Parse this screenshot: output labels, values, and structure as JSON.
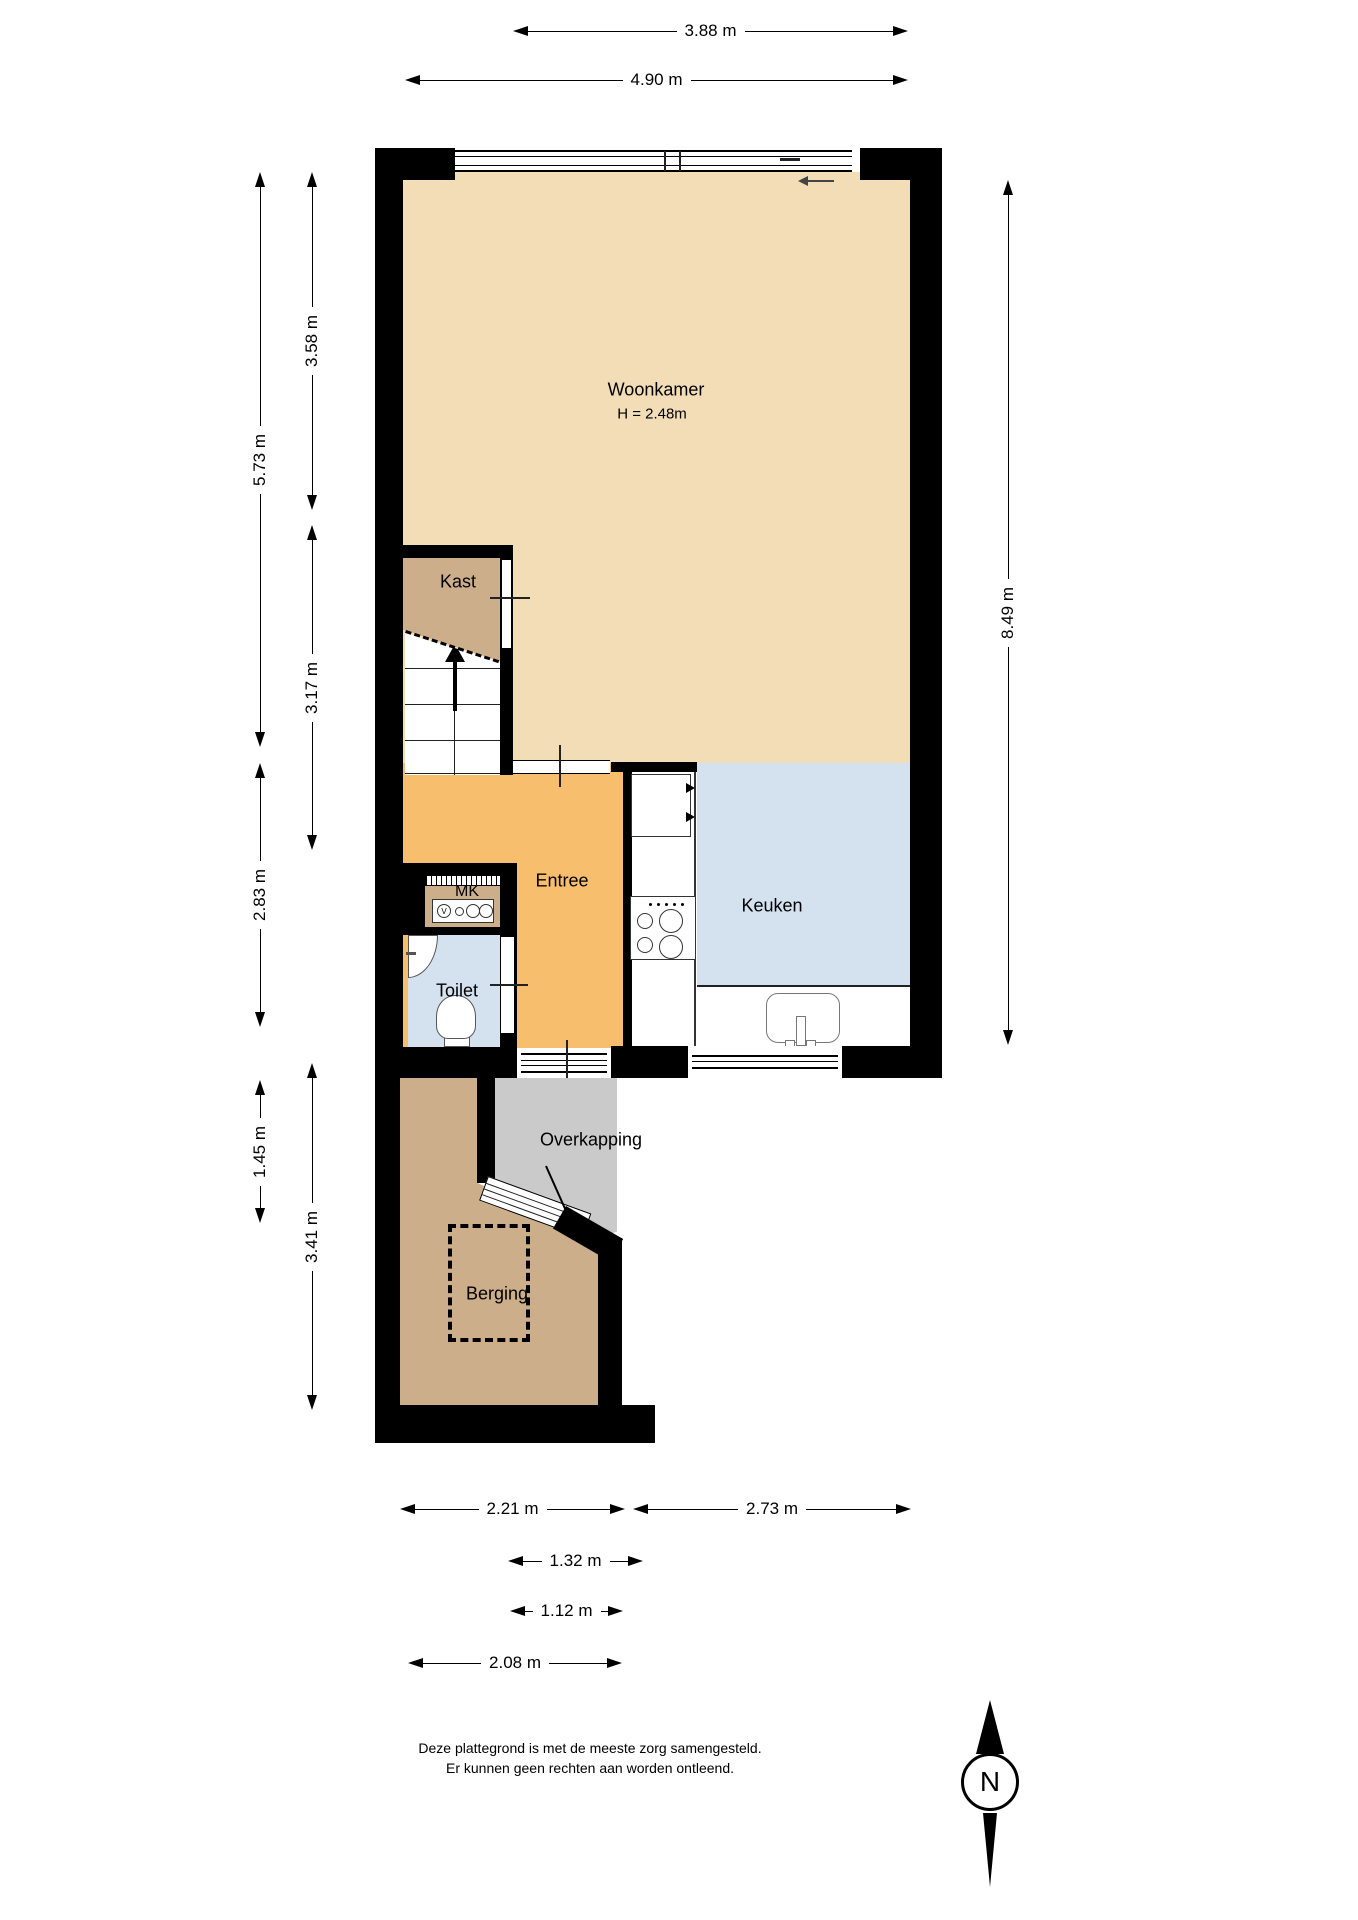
{
  "title": "floor-plan",
  "rooms": {
    "woonkamer": {
      "label": "Woonkamer",
      "height_note": "H = 2.48m"
    },
    "kast": {
      "label": "Kast"
    },
    "entree": {
      "label": "Entree"
    },
    "mk": {
      "label": "MK",
      "meter_letter": "V"
    },
    "toilet": {
      "label": "Toilet"
    },
    "keuken": {
      "label": "Keuken"
    },
    "overkapping": {
      "label": "Overkapping"
    },
    "berging": {
      "label": "Berging"
    }
  },
  "dimensions": {
    "top": [
      {
        "label": "3.88 m"
      },
      {
        "label": "4.90 m"
      }
    ],
    "right": [
      {
        "label": "8.49 m"
      }
    ],
    "left_outer": [
      {
        "label": "5.73 m"
      },
      {
        "label": "2.83 m"
      },
      {
        "label": "1.45 m"
      }
    ],
    "left_inner": [
      {
        "label": "3.58 m"
      },
      {
        "label": "3.17 m"
      },
      {
        "label": "3.41 m"
      }
    ],
    "bottom": [
      {
        "label": "2.21 m"
      },
      {
        "label": "2.73 m"
      },
      {
        "label": "1.32 m"
      },
      {
        "label": "1.12 m"
      },
      {
        "label": "2.08 m"
      }
    ]
  },
  "disclaimer": {
    "line1": "Deze plattegrond is met de meeste zorg samengesteld.",
    "line2": "Er kunnen geen rechten aan worden ontleend."
  },
  "compass": {
    "letter": "N"
  },
  "colors": {
    "wall": "#000000",
    "woonkamer_floor": "#F2DDB6",
    "entree_floor": "#F7BF6D",
    "kast_berging_floor": "#CDAE8A",
    "keuken_toilet_floor": "#D4E2F0",
    "overkapping_floor": "#CACACA"
  }
}
